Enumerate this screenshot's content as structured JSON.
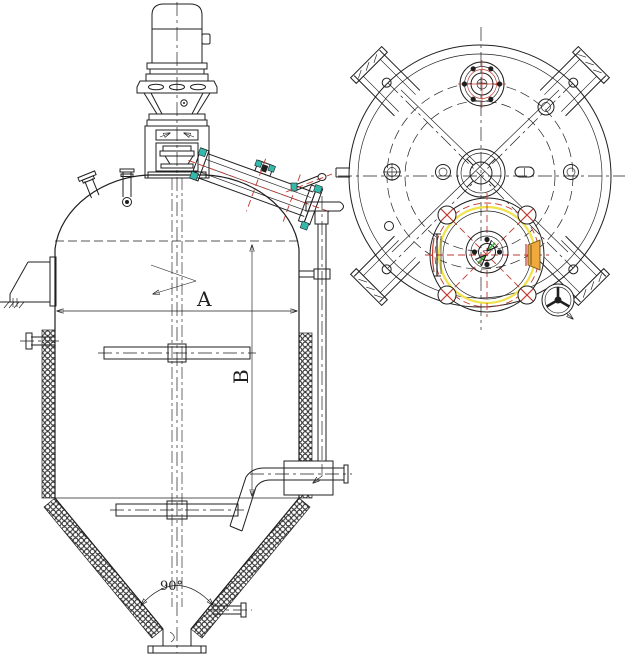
{
  "drawing": {
    "labels": {
      "dim_a": "A",
      "dim_b": "B",
      "cone_angle": "90°"
    },
    "colors": {
      "line": "#1f1f1f",
      "red": "#c0392f",
      "yellow": "#efe24b",
      "teal": "#35b8ac",
      "orange": "#f0a93c",
      "green": "#3db83d",
      "bg": "#ffffff"
    }
  }
}
